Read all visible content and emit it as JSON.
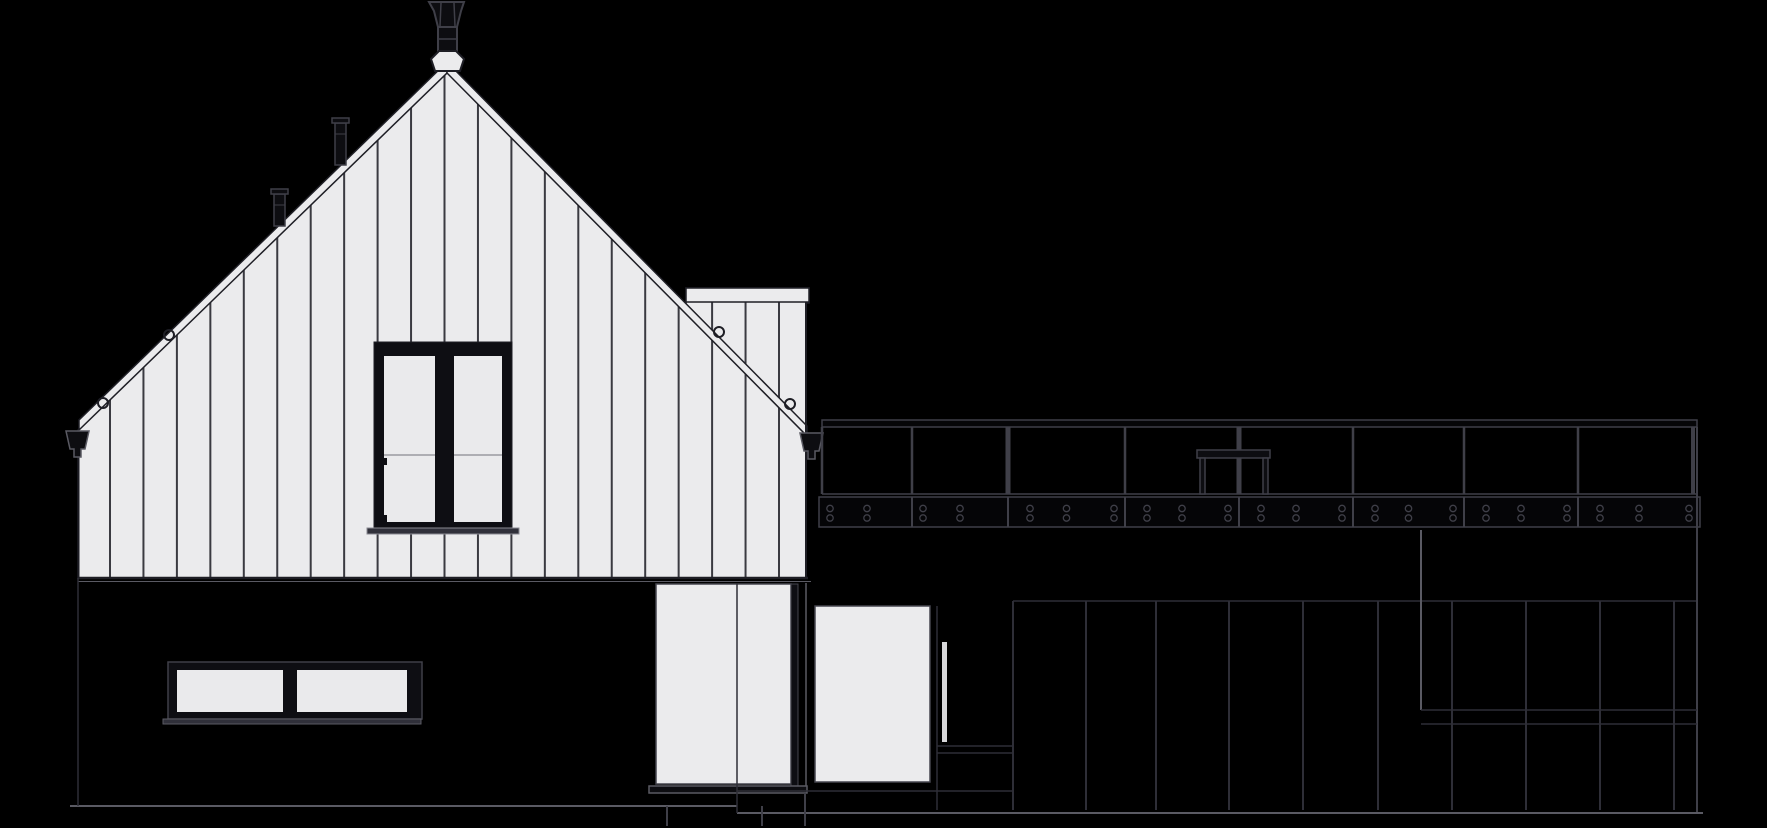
{
  "meta": {
    "description": "Black-and-white architectural side elevation drawing of a gabled house with vertical board-and-batten siding, rear dormer volume, deck with glass railing, lower dark-clad storey, doors and windows. No text labels are present in the image.",
    "canvas": {
      "width": 1767,
      "height": 828
    }
  },
  "colors": {
    "background": "#000000",
    "siding": "#ebebed",
    "siding_line": "#3a3a41",
    "outline_dark": "#1e1e25",
    "frame_black": "#0e0e13",
    "glass": "#eaeaec",
    "muntin": "#9a9aa0",
    "dark_fill": "#0d0d11",
    "gray_line": "#3f3f48",
    "gray_line_soft": "#2e2e37",
    "gray_line_bright": "#5a5a63",
    "sill_gray": "#30303a",
    "sill_edge": "#8a8a92",
    "door_outline": "#45454e"
  },
  "drawing": {
    "silhouette": [
      [
        78,
        578
      ],
      [
        78,
        430
      ],
      [
        447,
        64
      ],
      [
        684,
        305
      ],
      [
        686,
        305
      ],
      [
        686,
        288
      ],
      [
        809,
        288
      ],
      [
        809,
        303
      ],
      [
        806,
        303
      ],
      [
        806,
        578
      ]
    ],
    "battens": {
      "x_start": 110,
      "step": 33.45,
      "x_end": 800,
      "y_top": 55,
      "y_bottom": 578,
      "width": 2
    },
    "roof_bands": [
      {
        "points": [
          [
            447,
            62
          ],
          [
            79,
            420
          ],
          [
            79,
            430
          ],
          [
            447,
            73
          ]
        ]
      },
      {
        "points": [
          [
            447,
            62
          ],
          [
            807,
            426
          ],
          [
            807,
            436
          ],
          [
            447,
            73
          ]
        ]
      }
    ],
    "wall_edges": [
      {
        "p": [
          78.5,
          430,
          78.5,
          578
        ],
        "c": "outline_dark",
        "w": 2
      },
      {
        "p": [
          806,
          302,
          806,
          578
        ],
        "c": "outline_dark",
        "w": 2
      },
      {
        "p": [
          78,
          578,
          808,
          578
        ],
        "c": "outline_dark",
        "w": 2.5
      },
      {
        "p": [
          78,
          581.5,
          811,
          581.5
        ],
        "c": "gray_line_bright",
        "w": 1
      }
    ],
    "dormer": {
      "cap": [
        686,
        288,
        123,
        14
      ]
    },
    "chimney": {
      "cap_poly": [
        [
          429,
          2
        ],
        [
          464,
          2
        ],
        [
          461,
          11
        ],
        [
          457,
          27
        ],
        [
          438,
          27
        ],
        [
          434,
          11
        ]
      ],
      "cap_lines": [
        [
          441,
          3,
          440,
          26
        ],
        [
          454,
          3,
          455,
          26
        ]
      ],
      "shaft": [
        438,
        27,
        19,
        26
      ],
      "shaft_line_y": 39,
      "finial": [
        [
          439,
          51
        ],
        [
          456,
          51
        ],
        [
          464,
          59
        ],
        [
          460,
          71
        ],
        [
          435,
          71
        ],
        [
          431,
          59
        ]
      ]
    },
    "roof_vents": [
      {
        "cap": [
          271,
          189,
          17,
          5
        ],
        "body": [
          274,
          194,
          11,
          32
        ],
        "band_y": 205
      },
      {
        "cap": [
          332,
          118,
          17,
          5
        ],
        "body": [
          335,
          123,
          11,
          42
        ],
        "band_y": 134
      }
    ],
    "snow_hooks": [
      {
        "cx": 103,
        "cy": 403,
        "r": 5
      },
      {
        "cx": 169,
        "cy": 335,
        "r": 5
      },
      {
        "cx": 719,
        "cy": 332,
        "r": 5
      },
      {
        "cx": 790,
        "cy": 404,
        "r": 5
      }
    ],
    "picture_window": {
      "outer": [
        374,
        342,
        138,
        186
      ],
      "panes": [
        [
          384,
          356,
          51,
          166
        ],
        [
          454,
          356,
          48,
          166
        ]
      ],
      "transom_y": 455,
      "hinges": [
        [
          382,
          458,
          5,
          7
        ],
        [
          382,
          515,
          5,
          7
        ]
      ],
      "sill": [
        367,
        528,
        152,
        6
      ]
    },
    "basement_window": {
      "outer": [
        168,
        662,
        254,
        57
      ],
      "panes": [
        [
          177,
          670,
          106,
          42
        ],
        [
          297,
          670,
          110,
          42
        ]
      ],
      "sill": [
        163,
        719,
        258,
        5
      ]
    },
    "patio_door": {
      "rect": [
        656,
        584,
        135,
        200
      ],
      "jamb": [
        791,
        584,
        7,
        202
      ],
      "corner_line": [
        806,
        583,
        806,
        790
      ],
      "threshold": [
        649,
        786,
        158,
        7
      ]
    },
    "entry_door": {
      "rect": [
        815,
        606,
        115,
        176
      ],
      "slot": [
        942,
        642,
        5,
        100
      ],
      "side_line": [
        937,
        606,
        937,
        810
      ],
      "hlines": [
        [
          937,
          746,
          1013,
          746
        ],
        [
          937,
          753,
          1013,
          753
        ]
      ]
    },
    "gutter_funnels": [
      {
        "points": [
          [
            66,
            431
          ],
          [
            89,
            431
          ],
          [
            85,
            449
          ],
          [
            81,
            449
          ],
          [
            81,
            457
          ],
          [
            74,
            457
          ],
          [
            74,
            449
          ],
          [
            70,
            449
          ]
        ]
      },
      {
        "points": [
          [
            800,
            433
          ],
          [
            823,
            433
          ],
          [
            819,
            451
          ],
          [
            815,
            451
          ],
          [
            815,
            459
          ],
          [
            808,
            459
          ],
          [
            808,
            451
          ],
          [
            804,
            451
          ]
        ]
      }
    ],
    "deck_railing": {
      "rail": [
        822,
        420,
        875,
        7
      ],
      "posts": [
        {
          "x": 822,
          "w": 2.5
        },
        {
          "x": 912,
          "w": 2.5
        },
        {
          "x": 1008,
          "w": 5
        },
        {
          "x": 1125,
          "w": 2.5
        },
        {
          "x": 1239,
          "w": 5
        },
        {
          "x": 1353,
          "w": 2.5
        },
        {
          "x": 1464,
          "w": 2.5
        },
        {
          "x": 1578,
          "w": 2.5
        },
        {
          "x": 1693,
          "w": 4
        }
      ],
      "post_top_y": 427,
      "glass_bottom_y": 494,
      "table": {
        "top": [
          1197,
          450,
          73,
          8
        ],
        "legs": [
          [
            1200,
            458,
            5,
            36
          ],
          [
            1263,
            458,
            5,
            36
          ]
        ]
      }
    },
    "deck_fascia": {
      "rect": [
        819,
        497,
        881,
        30
      ],
      "segments": [
        819,
        912,
        1008,
        1125,
        1239,
        1353,
        1464,
        1578,
        1700
      ],
      "bolt_rows": [
        508.5,
        518
      ],
      "bolt_r": 3.2
    },
    "lower_cladding": {
      "top_line": [
        1013,
        601,
        1697,
        601
      ],
      "seams_x": [
        1013,
        1086,
        1156,
        1229,
        1303,
        1378,
        1452,
        1526,
        1600,
        1674
      ],
      "seam_y": [
        601,
        810
      ],
      "right_edge": [
        1697,
        427,
        1697,
        813
      ],
      "bright_edge": [
        1421,
        530,
        1421,
        710
      ],
      "hlines": [
        [
          1421,
          710,
          1697,
          710
        ],
        [
          1421,
          724,
          1697,
          724
        ]
      ]
    },
    "ground_lines": [
      {
        "p": [
          70,
          806,
          737,
          806
        ],
        "c": "gray_line_bright",
        "w": 2
      },
      {
        "p": [
          737,
          813,
          1703,
          813
        ],
        "c": "gray_line_bright",
        "w": 2
      },
      {
        "p": [
          667,
          806,
          667,
          826
        ],
        "c": "gray_line",
        "w": 2
      },
      {
        "p": [
          762,
          806,
          762,
          826
        ],
        "c": "gray_line",
        "w": 2
      },
      {
        "p": [
          805,
          793,
          805,
          826
        ],
        "c": "gray_line",
        "w": 2
      },
      {
        "p": [
          737,
          791,
          1013,
          791
        ],
        "c": "gray_line_soft",
        "w": 1.5
      },
      {
        "p": [
          737,
          583,
          737,
          813
        ],
        "c": "gray_line_soft",
        "w": 1.5
      },
      {
        "p": [
          78,
          578,
          78,
          806
        ],
        "c": "gray_line_soft",
        "w": 1.5
      }
    ]
  }
}
